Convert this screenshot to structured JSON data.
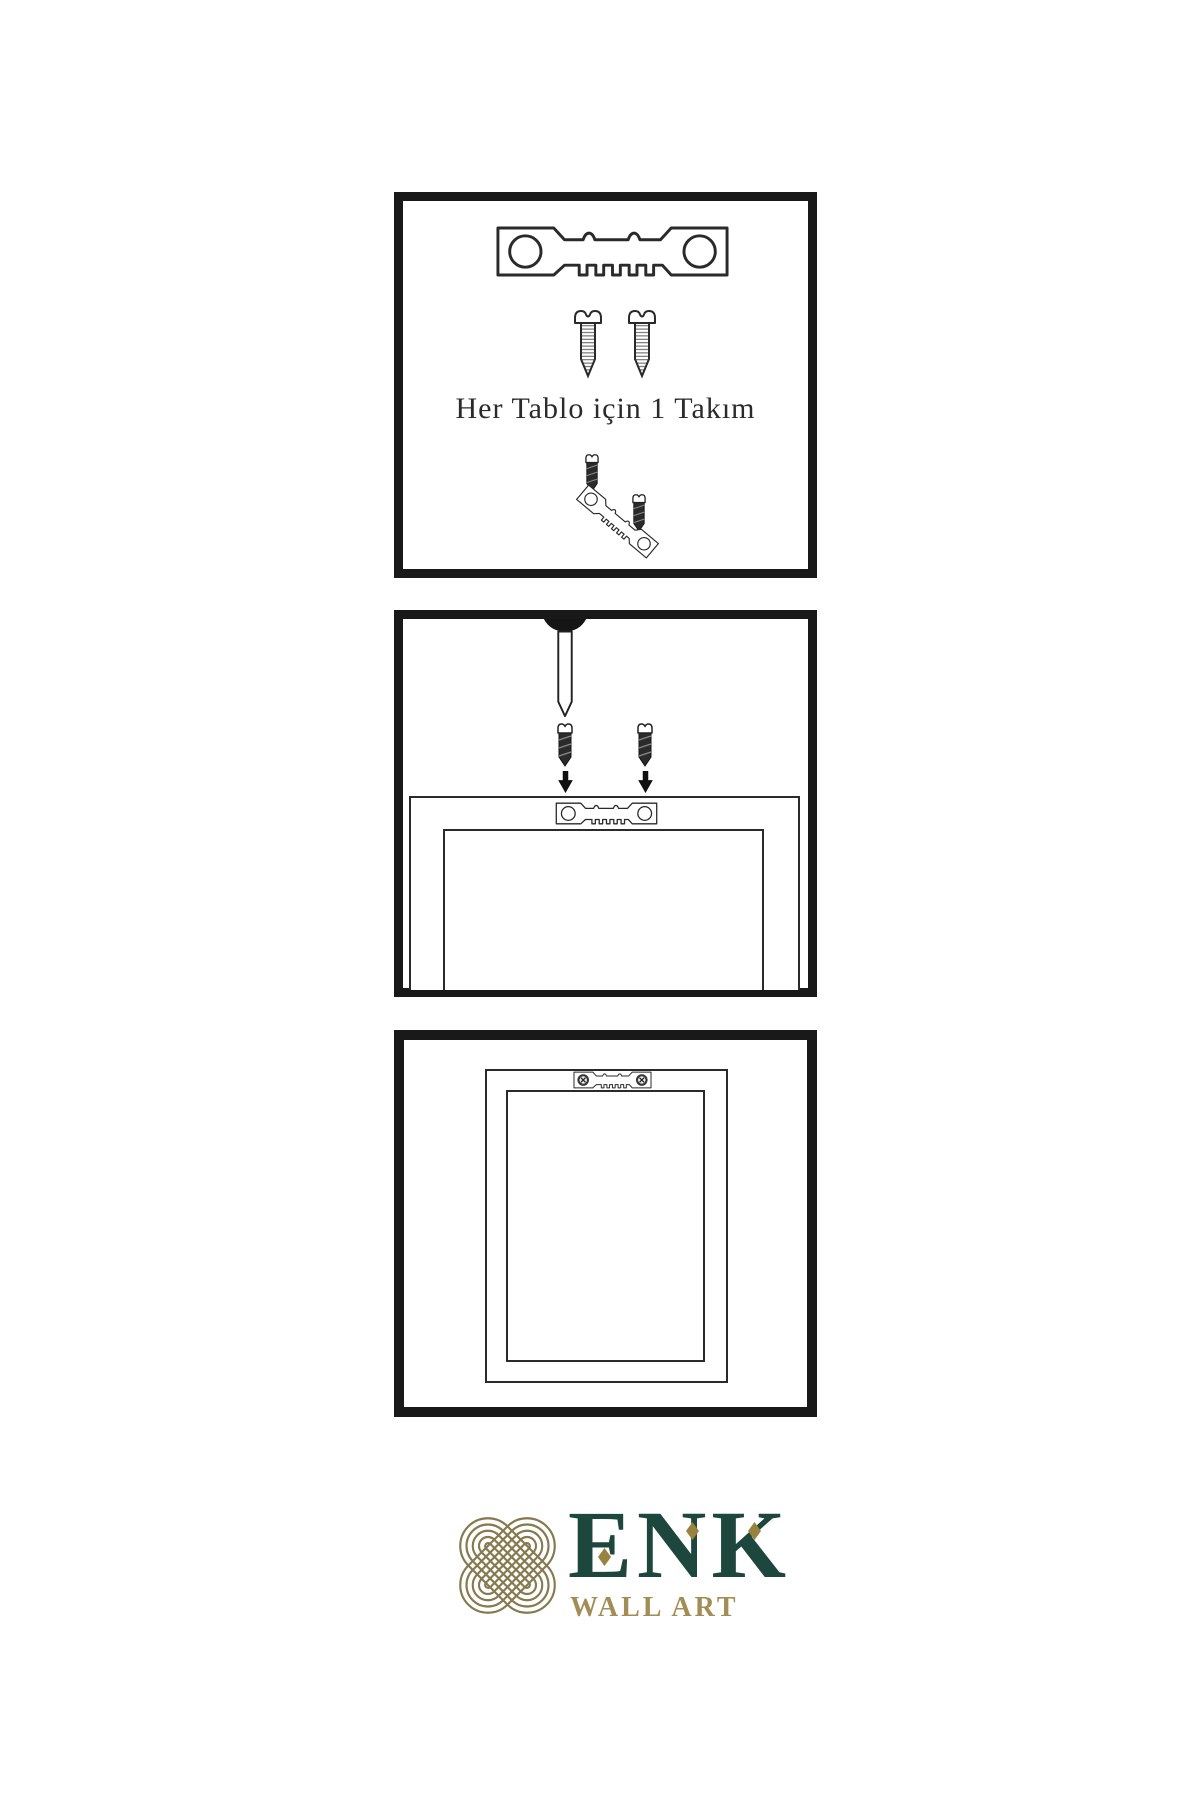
{
  "instructions": {
    "steps": [
      {
        "id": 1,
        "caption": "Her Tablo için 1 Takım",
        "items": [
          "sawtooth-hanger",
          "screw",
          "screw",
          "screw-hanger-assembly"
        ]
      },
      {
        "id": 2,
        "items": [
          "wall-nail",
          "screw-with-down-arrow",
          "screw-with-down-arrow",
          "frame-back-with-sawtooth-hanger"
        ]
      },
      {
        "id": 3,
        "items": [
          "frame-back-with-mounted-hanger"
        ]
      }
    ]
  },
  "brand": {
    "name": "ENK",
    "tagline": "WALL ART"
  },
  "colors": {
    "background": "#ffffff",
    "panel_border": "#191919",
    "diagram_line": "#2a2a2a",
    "screw_dark_fill": "#2b2b2b",
    "brand_green": "#1d473c",
    "knot_gold": "#86794e",
    "diamond_gold": "#97823e",
    "tagline_gold": "#a28d55"
  }
}
